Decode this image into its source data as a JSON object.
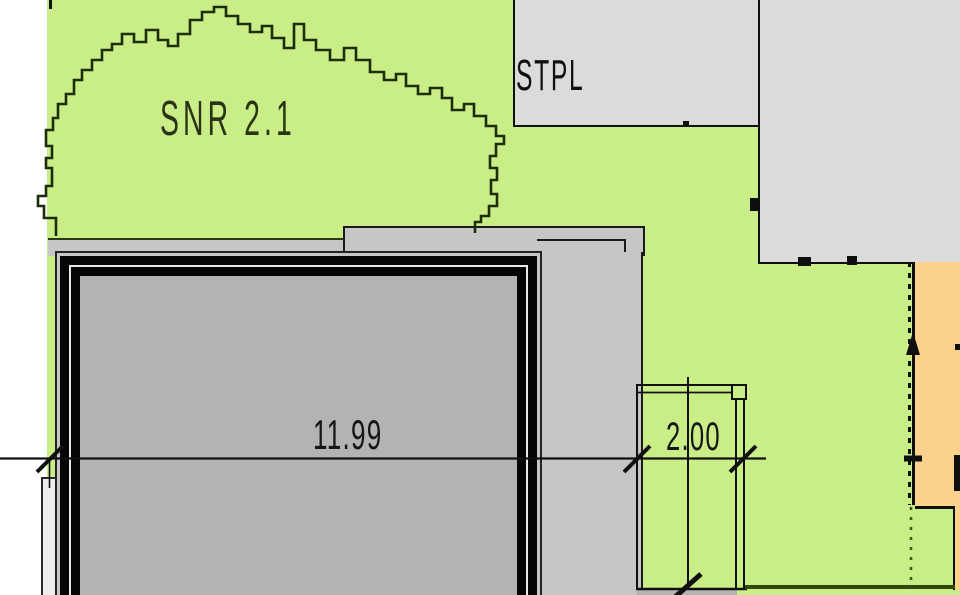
{
  "plan": {
    "labels": {
      "area": "SNR 2.1",
      "parking": "STPL"
    },
    "dimensions": {
      "main": "11.99",
      "side": "2.00"
    },
    "colors": {
      "green_area": "#c9ee87",
      "gray_parking": "#dbdbdb",
      "gray_band": "#c6c6c6",
      "gray_building": "#b3b3b3",
      "orange_area": "#fbd28c",
      "line_black": "#0f0f0f",
      "line_dark_green": "#2e4a08",
      "canopy_outline": "#1c2d08"
    }
  }
}
